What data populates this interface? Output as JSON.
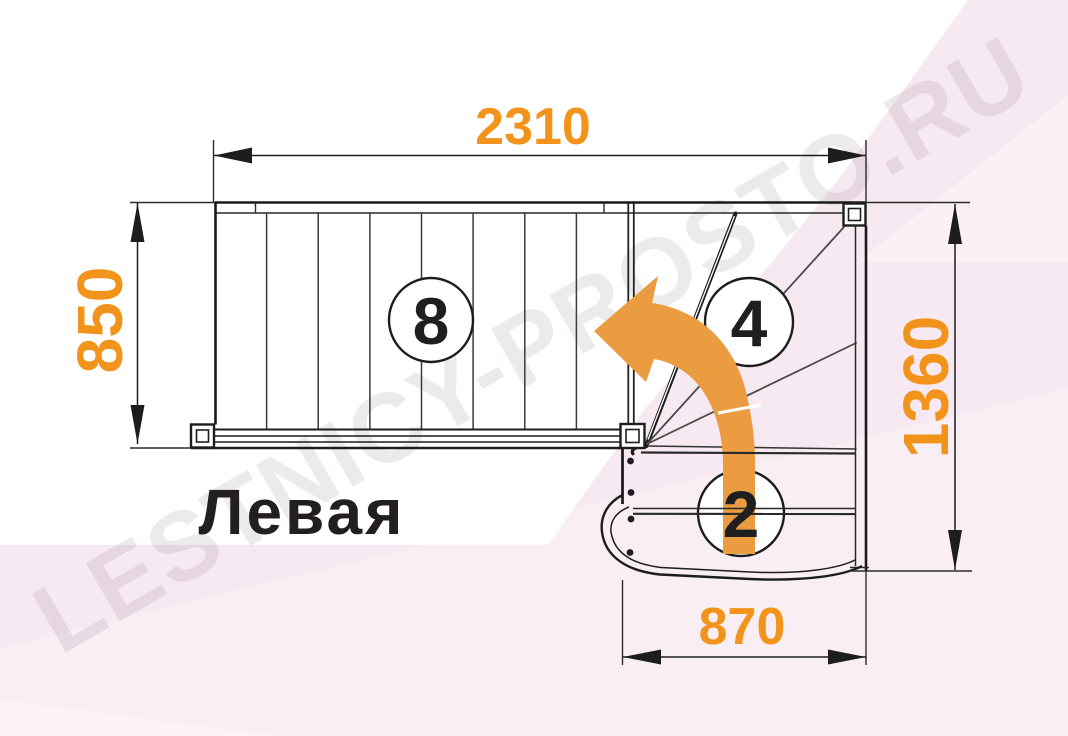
{
  "diagram": {
    "title": "Левая",
    "watermark": "LESTNICY-PROSTO.RU",
    "dimensions": {
      "top": "2310",
      "left": "850",
      "right": "1360",
      "bottom": "870"
    },
    "step_counts": {
      "straight_flight": "8",
      "winder_steps": "4",
      "bottom_steps": "2"
    },
    "icons": {
      "direction_arrow": "curved-left-up-turn-arrow"
    },
    "colors": {
      "dimension_orange": "#F2941C",
      "arrow_orange": "#EB9B40",
      "line_black": "#1D1D1D",
      "background_pink": "#F7E9F1"
    }
  }
}
